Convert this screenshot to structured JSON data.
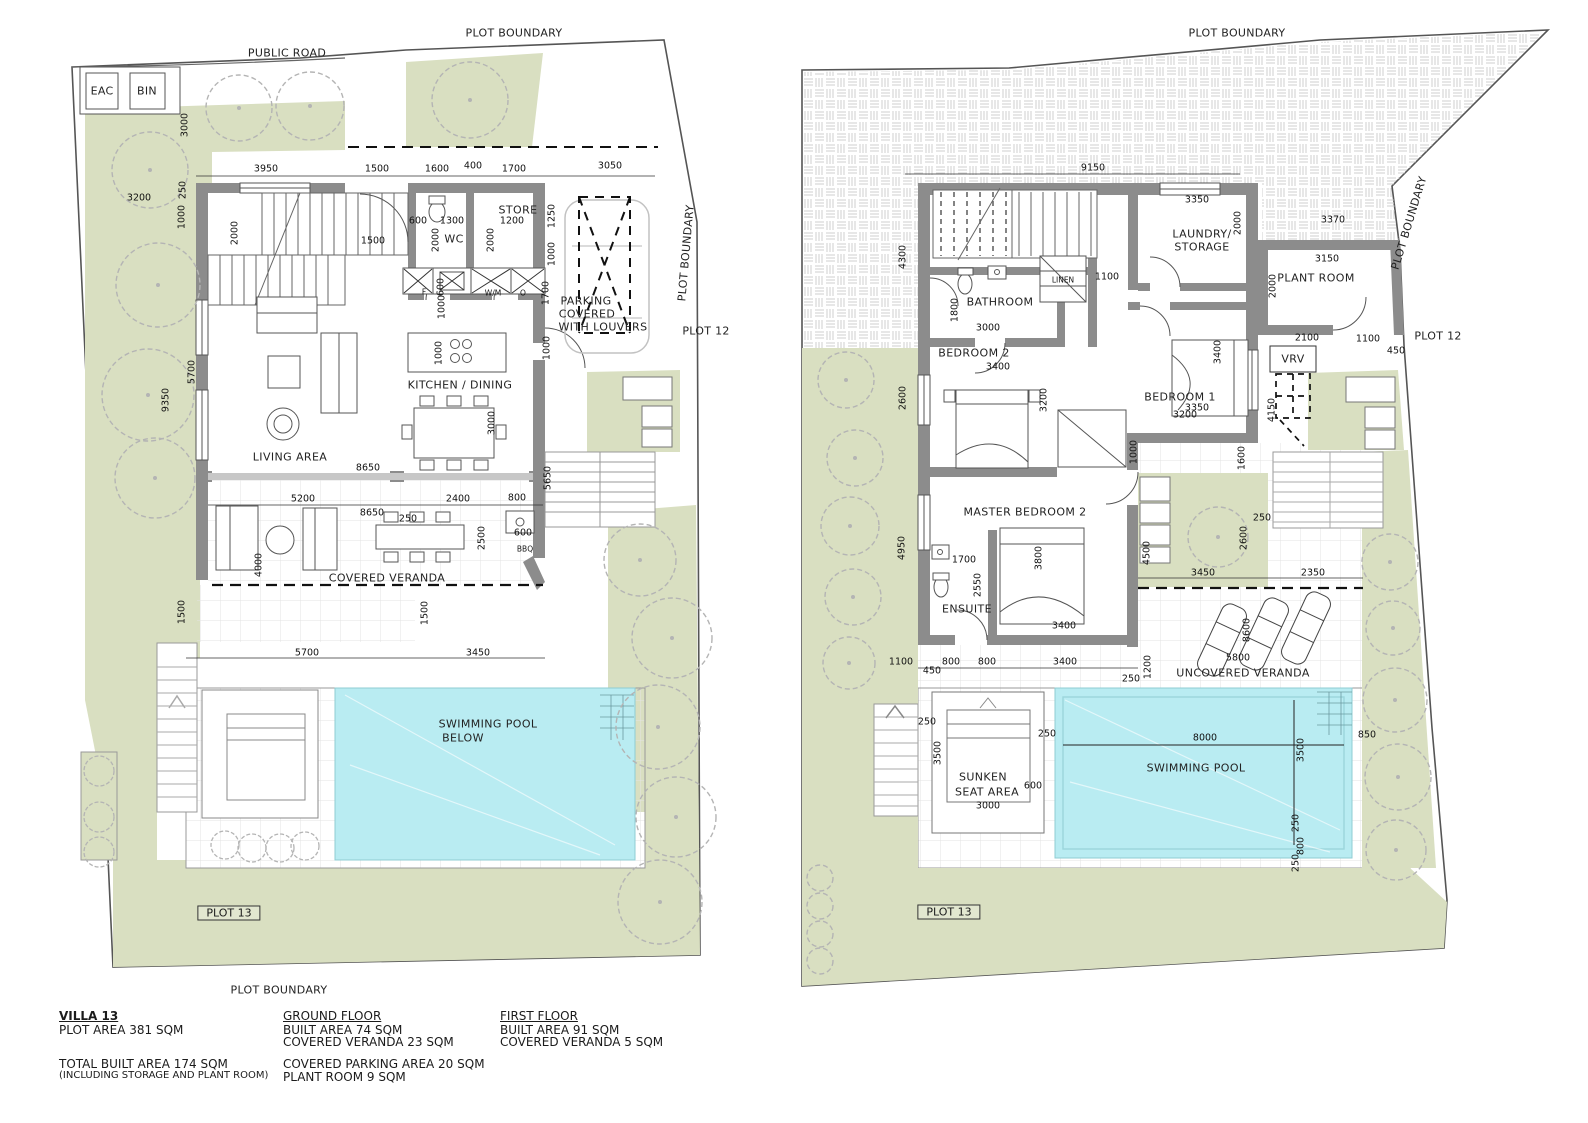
{
  "colors": {
    "landscape_green": "#d9dfc1",
    "pool_cyan": "#b9ecf2",
    "wall_gray": "#8c8c8c",
    "hatch_gray": "#cccccc",
    "tree_gray": "#b4b4b4",
    "line_dark": "#444444"
  },
  "footer": {
    "villa": {
      "title": "VILLA 13",
      "plot_area": "PLOT AREA 381 SQM",
      "total": "TOTAL BUILT AREA 174 SQM",
      "note": "(INCLUDING STORAGE AND PLANT ROOM)"
    },
    "ground_floor": {
      "title": "GROUND FLOOR",
      "lines": [
        "BUILT AREA 74 SQM",
        "COVERED VERANDA 23 SQM",
        "COVERED PARKING AREA 20 SQM",
        "PLANT ROOM 9 SQM"
      ]
    },
    "first_floor": {
      "title": "FIRST FLOOR",
      "lines": [
        "BUILT AREA 91 SQM",
        "COVERED VERANDA 5 SQM"
      ]
    }
  },
  "plans": [
    {
      "name": "ground-floor",
      "labels": [
        {
          "t": "PUBLIC ROAD",
          "x": 287,
          "y": 53,
          "c": "pl"
        },
        {
          "t": "PLOT BOUNDARY",
          "x": 514,
          "y": 33,
          "c": "pl"
        },
        {
          "t": "PLOT BOUNDARY",
          "x": 686,
          "y": 253,
          "r": -85,
          "c": "pl"
        },
        {
          "t": "PLOT 12",
          "x": 706,
          "y": 331,
          "c": "pl"
        },
        {
          "t": "PLOT 13",
          "x": 229,
          "y": 913,
          "c": "bx"
        },
        {
          "t": "PLOT BOUNDARY",
          "x": 279,
          "y": 990,
          "c": "pl"
        },
        {
          "t": "EAC",
          "x": 102,
          "y": 91,
          "c": "pl"
        },
        {
          "t": "BIN",
          "x": 147,
          "y": 91,
          "c": "pl"
        },
        {
          "t": "WC",
          "x": 454,
          "y": 239,
          "c": "rm"
        },
        {
          "t": "STORE",
          "x": 518,
          "y": 210,
          "c": "rm"
        },
        {
          "t": "KITCHEN / DINING",
          "x": 460,
          "y": 385,
          "c": "rm"
        },
        {
          "t": "LIVING AREA",
          "x": 290,
          "y": 457,
          "c": "rm"
        },
        {
          "t": "COVERED VERANDA",
          "x": 387,
          "y": 578,
          "c": "rm"
        },
        {
          "t": "PARKING",
          "x": 586,
          "y": 301,
          "c": "rm"
        },
        {
          "t": "COVERED",
          "x": 587,
          "y": 314,
          "c": "rm"
        },
        {
          "t": "WITH LOUVERS",
          "x": 603,
          "y": 327,
          "c": "rm"
        },
        {
          "t": "SWIMMING POOL",
          "x": 488,
          "y": 724,
          "c": "rm"
        },
        {
          "t": "BELOW",
          "x": 463,
          "y": 738,
          "c": "rm"
        },
        {
          "t": "F",
          "x": 424,
          "y": 292,
          "c": "tn"
        },
        {
          "t": "W/M",
          "x": 493,
          "y": 293,
          "c": "tn"
        },
        {
          "t": "O",
          "x": 523,
          "y": 293,
          "c": "tn"
        },
        {
          "t": "BBQ",
          "x": 525,
          "y": 549,
          "c": "tn"
        },
        {
          "t": "3950",
          "x": 266,
          "y": 169
        },
        {
          "t": "1500",
          "x": 377,
          "y": 169
        },
        {
          "t": "1600",
          "x": 437,
          "y": 169
        },
        {
          "t": "400",
          "x": 473,
          "y": 166
        },
        {
          "t": "1700",
          "x": 514,
          "y": 169
        },
        {
          "t": "3050",
          "x": 610,
          "y": 166
        },
        {
          "t": "3200",
          "x": 139,
          "y": 198
        },
        {
          "t": "3000",
          "x": 185,
          "y": 125,
          "r": -90
        },
        {
          "t": "250",
          "x": 183,
          "y": 190,
          "r": -90
        },
        {
          "t": "1000",
          "x": 182,
          "y": 217,
          "r": -90
        },
        {
          "t": "2000",
          "x": 235,
          "y": 233,
          "r": -90
        },
        {
          "t": "1500",
          "x": 373,
          "y": 241
        },
        {
          "t": "600",
          "x": 418,
          "y": 221
        },
        {
          "t": "1300",
          "x": 452,
          "y": 221
        },
        {
          "t": "1200",
          "x": 512,
          "y": 221
        },
        {
          "t": "2000",
          "x": 436,
          "y": 240,
          "r": -90
        },
        {
          "t": "2000",
          "x": 491,
          "y": 240,
          "r": -90
        },
        {
          "t": "1250",
          "x": 552,
          "y": 216,
          "r": -90
        },
        {
          "t": "1000",
          "x": 552,
          "y": 254,
          "r": -90
        },
        {
          "t": "1700",
          "x": 546,
          "y": 293,
          "r": -90
        },
        {
          "t": "1000",
          "x": 547,
          "y": 348,
          "r": -90
        },
        {
          "t": "600",
          "x": 441,
          "y": 287,
          "r": -90
        },
        {
          "t": "1000",
          "x": 442,
          "y": 307,
          "r": -90
        },
        {
          "t": "1000",
          "x": 439,
          "y": 353,
          "r": -90
        },
        {
          "t": "9350",
          "x": 166,
          "y": 400,
          "r": -90
        },
        {
          "t": "5700",
          "x": 192,
          "y": 372,
          "r": -90
        },
        {
          "t": "3000",
          "x": 492,
          "y": 423,
          "r": -90
        },
        {
          "t": "8650",
          "x": 368,
          "y": 468
        },
        {
          "t": "5650",
          "x": 548,
          "y": 478,
          "r": -90
        },
        {
          "t": "5200",
          "x": 303,
          "y": 499
        },
        {
          "t": "2400",
          "x": 458,
          "y": 499
        },
        {
          "t": "800",
          "x": 517,
          "y": 498
        },
        {
          "t": "8650",
          "x": 372,
          "y": 513
        },
        {
          "t": "250",
          "x": 408,
          "y": 519
        },
        {
          "t": "2500",
          "x": 482,
          "y": 538,
          "r": -90
        },
        {
          "t": "600",
          "x": 523,
          "y": 533
        },
        {
          "t": "4000",
          "x": 259,
          "y": 565,
          "r": -90
        },
        {
          "t": "1500",
          "x": 425,
          "y": 613,
          "r": -90
        },
        {
          "t": "1500",
          "x": 182,
          "y": 612,
          "r": -90
        },
        {
          "t": "5700",
          "x": 307,
          "y": 653
        },
        {
          "t": "3450",
          "x": 478,
          "y": 653
        }
      ]
    },
    {
      "name": "first-floor",
      "labels": [
        {
          "t": "PLOT BOUNDARY",
          "x": 1237,
          "y": 33,
          "c": "pl"
        },
        {
          "t": "PLOT BOUNDARY",
          "x": 1409,
          "y": 223,
          "r": -73,
          "c": "pl"
        },
        {
          "t": "PLOT 12",
          "x": 1438,
          "y": 336,
          "c": "pl"
        },
        {
          "t": "PLOT 13",
          "x": 949,
          "y": 912,
          "c": "bx"
        },
        {
          "t": "BATHROOM",
          "x": 1000,
          "y": 302,
          "c": "rm"
        },
        {
          "t": "LINEN",
          "x": 1063,
          "y": 280,
          "c": "tn"
        },
        {
          "t": "LAUNDRY/",
          "x": 1202,
          "y": 234,
          "c": "rm"
        },
        {
          "t": "STORAGE",
          "x": 1202,
          "y": 247,
          "c": "rm"
        },
        {
          "t": "BEDROOM 2",
          "x": 974,
          "y": 353,
          "c": "rm"
        },
        {
          "t": "BEDROOM 1",
          "x": 1180,
          "y": 397,
          "c": "rm"
        },
        {
          "t": "PLANT ROOM",
          "x": 1316,
          "y": 278,
          "c": "rm"
        },
        {
          "t": "VRV",
          "x": 1293,
          "y": 359,
          "c": "rm"
        },
        {
          "t": "MASTER BEDROOM 2",
          "x": 1025,
          "y": 512,
          "c": "rm"
        },
        {
          "t": "ENSUITE",
          "x": 967,
          "y": 609,
          "c": "rm"
        },
        {
          "t": "UNCOVERED VERANDA",
          "x": 1243,
          "y": 673,
          "c": "rm"
        },
        {
          "t": "SUNKEN",
          "x": 983,
          "y": 777,
          "c": "rm"
        },
        {
          "t": "SEAT AREA",
          "x": 987,
          "y": 792,
          "c": "rm"
        },
        {
          "t": "SWIMMING POOL",
          "x": 1196,
          "y": 768,
          "c": "rm"
        },
        {
          "t": "9150",
          "x": 1093,
          "y": 168
        },
        {
          "t": "3350",
          "x": 1197,
          "y": 200
        },
        {
          "t": "2000",
          "x": 1238,
          "y": 223,
          "r": -90
        },
        {
          "t": "3370",
          "x": 1333,
          "y": 220
        },
        {
          "t": "3150",
          "x": 1327,
          "y": 259
        },
        {
          "t": "2000",
          "x": 1273,
          "y": 286,
          "r": -90
        },
        {
          "t": "2100",
          "x": 1307,
          "y": 338
        },
        {
          "t": "1100",
          "x": 1368,
          "y": 339
        },
        {
          "t": "450",
          "x": 1396,
          "y": 351
        },
        {
          "t": "4300",
          "x": 903,
          "y": 257,
          "r": -90
        },
        {
          "t": "1800",
          "x": 955,
          "y": 310,
          "r": -90
        },
        {
          "t": "3000",
          "x": 988,
          "y": 328
        },
        {
          "t": "1100",
          "x": 1107,
          "y": 277
        },
        {
          "t": "3400",
          "x": 998,
          "y": 367
        },
        {
          "t": "3200",
          "x": 1044,
          "y": 400,
          "r": -90
        },
        {
          "t": "3350",
          "x": 1197,
          "y": 408
        },
        {
          "t": "3400",
          "x": 1218,
          "y": 352,
          "r": -90
        },
        {
          "t": "2600",
          "x": 903,
          "y": 398,
          "r": -90
        },
        {
          "t": "4150",
          "x": 1272,
          "y": 410,
          "r": -90
        },
        {
          "t": "3200",
          "x": 1185,
          "y": 415
        },
        {
          "t": "1000",
          "x": 1134,
          "y": 452,
          "r": -90
        },
        {
          "t": "1600",
          "x": 1242,
          "y": 458,
          "r": -90
        },
        {
          "t": "250",
          "x": 1262,
          "y": 518
        },
        {
          "t": "2600",
          "x": 1244,
          "y": 538,
          "r": -90
        },
        {
          "t": "4500",
          "x": 1147,
          "y": 553,
          "r": -90
        },
        {
          "t": "3450",
          "x": 1203,
          "y": 573
        },
        {
          "t": "2350",
          "x": 1313,
          "y": 573
        },
        {
          "t": "4950",
          "x": 902,
          "y": 548,
          "r": -90
        },
        {
          "t": "1700",
          "x": 964,
          "y": 560
        },
        {
          "t": "2550",
          "x": 978,
          "y": 585,
          "r": -90
        },
        {
          "t": "3800",
          "x": 1039,
          "y": 558,
          "r": -90
        },
        {
          "t": "3400",
          "x": 1064,
          "y": 626
        },
        {
          "t": "1100",
          "x": 901,
          "y": 662
        },
        {
          "t": "450",
          "x": 932,
          "y": 671
        },
        {
          "t": "800",
          "x": 951,
          "y": 662
        },
        {
          "t": "800",
          "x": 987,
          "y": 662
        },
        {
          "t": "3400",
          "x": 1065,
          "y": 662
        },
        {
          "t": "250",
          "x": 1131,
          "y": 679
        },
        {
          "t": "1200",
          "x": 1148,
          "y": 667,
          "r": -90
        },
        {
          "t": "5800",
          "x": 1238,
          "y": 658
        },
        {
          "t": "8600",
          "x": 1247,
          "y": 630,
          "r": -90
        },
        {
          "t": "250",
          "x": 927,
          "y": 722
        },
        {
          "t": "3500",
          "x": 938,
          "y": 753,
          "r": -90
        },
        {
          "t": "600",
          "x": 1033,
          "y": 786
        },
        {
          "t": "3000",
          "x": 988,
          "y": 806
        },
        {
          "t": "250",
          "x": 1047,
          "y": 734
        },
        {
          "t": "8000",
          "x": 1205,
          "y": 738
        },
        {
          "t": "3500",
          "x": 1301,
          "y": 750,
          "r": -90
        },
        {
          "t": "850",
          "x": 1367,
          "y": 735
        },
        {
          "t": "250",
          "x": 1296,
          "y": 823,
          "r": -90
        },
        {
          "t": "800",
          "x": 1301,
          "y": 846,
          "r": -90
        },
        {
          "t": "250",
          "x": 1296,
          "y": 863,
          "r": -90
        }
      ]
    }
  ]
}
